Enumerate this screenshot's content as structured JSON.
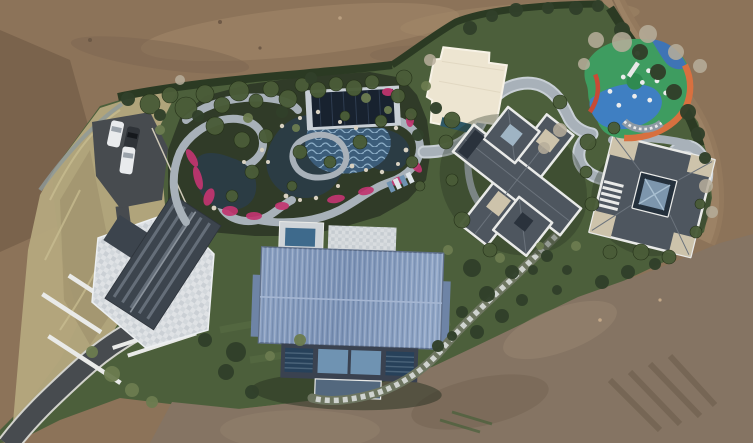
{
  "scene": {
    "description": "Aerial drone photograph, top-down view of a landscaped private estate under construction, surrounded by bare brown earth. A winding water garden with ponds, pink flower beds and stone paths sits at upper left; a large blue metal-roofed hall sits at center; a stone-terraced house at left; two dark-slate-roofed villas at right; a colorful children's playground at upper right; an asphalt driveway and parking pad with three cars at left; a dirt road curves along the upper right.",
    "objects": {
      "buildings": 4,
      "cars": 3,
      "ponds": 3,
      "playgrounds": 1,
      "parking_pads": 1,
      "roads": 2
    }
  },
  "palette": {
    "dirt": "#8C7359",
    "dirtDark": "#6E5844",
    "dirtLight": "#A68B6C",
    "dirtBottom": "#857463",
    "dirtRoad": "#9C8265",
    "hedge": "#2B3A23",
    "lawn": "#4C5F3B",
    "lawnLight": "#5E7247",
    "gardenGround": "#303B28",
    "shrubDark": "#31402A",
    "shrubMid": "#4A5C38",
    "shrubLight": "#6C7C50",
    "treeBare": "#B7AE9B",
    "dryGrass": "#B5A87E",
    "dryGrassDark": "#9C8F6B",
    "asphalt": "#474B4F",
    "roadEdge": "#D2D2CC",
    "pathGray": "#A8B1B9",
    "pathEdge": "#C8CFD5",
    "stoneWhite": "#DCE0E3",
    "water": "#2B3C44",
    "wavePool": "#3C5D7A",
    "flower": "#C23570",
    "rock": "#D8D1C1",
    "pavilion": "#18222F",
    "blueRoofEdge": "#5D6E8A",
    "facade": "#3A4250",
    "windowBlue": "#6F93B2",
    "windowDark": "#27415A",
    "slate": "#4E565F",
    "slateDark": "#3C444D",
    "trim": "#E9EAE8",
    "beige": "#CDC3AB",
    "cream": "#EDE5D1",
    "playGreen": "#3E9C60",
    "playGreenDark": "#2F8A50",
    "playBlue": "#3F7FC2",
    "playOrange": "#D8703F",
    "playRed": "#C84B36",
    "playGray": "#8D99A4",
    "carWhite": "#E9EBED",
    "carDark": "#2F3338",
    "poolBlue": "#3E6A8C"
  }
}
